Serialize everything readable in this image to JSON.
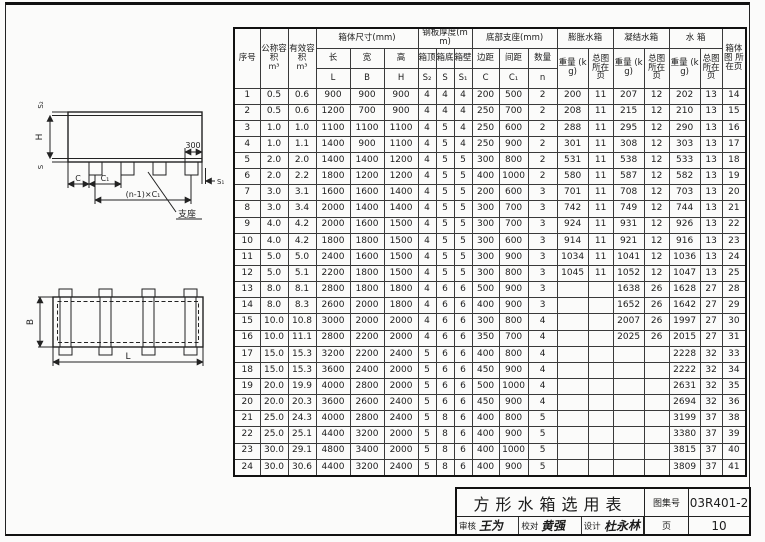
{
  "title_block": {
    "title": "方形水箱选用表",
    "atlas_label": "图集号",
    "atlas_no": "03R401-2",
    "page_label": "页",
    "page_no": "10",
    "reviewer_label": "审核",
    "reviewer": "王为",
    "checker_label": "校对",
    "checker": "黄强",
    "designer_label": "设计",
    "designer": "杜永林"
  },
  "diagrams": {
    "elevation": {
      "s_top": "S₂",
      "h": "H",
      "s_bottom": "S",
      "dim_300": "300",
      "s_side": "S₁",
      "c": "C",
      "c1": "C₁",
      "span": "(n-1)×C₁",
      "support": "支座"
    },
    "plan": {
      "b": "B",
      "l": "L"
    }
  },
  "table": {
    "header": {
      "seq": "序号",
      "nominal": "公称容积",
      "effective": "有效容积",
      "unit": "m³",
      "dims_group": "箱体尺寸(mm)",
      "dim_cn": [
        "长",
        "宽",
        "高"
      ],
      "dim_sym": [
        "L",
        "B",
        "H"
      ],
      "steel_group": "钢板厚度(mm)",
      "steel_cn": [
        "箱顶",
        "箱底",
        "箱壁"
      ],
      "steel_sym": [
        "S₂",
        "S",
        "S₁"
      ],
      "support_group": "底部支座(mm)",
      "support_cn": [
        "边距",
        "间距",
        "数量"
      ],
      "support_sym": [
        "C",
        "C₁",
        "n"
      ],
      "groups": [
        {
          "name": "膨胀水箱"
        },
        {
          "name": "凝结水箱"
        },
        {
          "name": "水 箱"
        }
      ],
      "weight": "重量 (kg)",
      "page_ref": "总图 所在页",
      "body_page": "箱体图 所在页"
    },
    "rows": [
      [
        "1",
        "0.5",
        "0.6",
        "900",
        "900",
        "900",
        "4",
        "4",
        "4",
        "200",
        "500",
        "2",
        "200",
        "11",
        "207",
        "12",
        "202",
        "13",
        "14"
      ],
      [
        "2",
        "0.5",
        "0.6",
        "1200",
        "700",
        "900",
        "4",
        "4",
        "4",
        "250",
        "700",
        "2",
        "208",
        "11",
        "215",
        "12",
        "210",
        "13",
        "15"
      ],
      [
        "3",
        "1.0",
        "1.0",
        "1100",
        "1100",
        "1100",
        "4",
        "5",
        "4",
        "250",
        "600",
        "2",
        "288",
        "11",
        "295",
        "12",
        "290",
        "13",
        "16"
      ],
      [
        "4",
        "1.0",
        "1.1",
        "1400",
        "900",
        "1100",
        "4",
        "5",
        "4",
        "250",
        "900",
        "2",
        "301",
        "11",
        "308",
        "12",
        "303",
        "13",
        "17"
      ],
      [
        "5",
        "2.0",
        "2.0",
        "1400",
        "1400",
        "1200",
        "4",
        "5",
        "5",
        "300",
        "800",
        "2",
        "531",
        "11",
        "538",
        "12",
        "533",
        "13",
        "18"
      ],
      [
        "6",
        "2.0",
        "2.2",
        "1800",
        "1200",
        "1200",
        "4",
        "5",
        "5",
        "400",
        "1000",
        "2",
        "580",
        "11",
        "587",
        "12",
        "582",
        "13",
        "19"
      ],
      [
        "7",
        "3.0",
        "3.1",
        "1600",
        "1600",
        "1400",
        "4",
        "5",
        "5",
        "200",
        "600",
        "3",
        "701",
        "11",
        "708",
        "12",
        "703",
        "13",
        "20"
      ],
      [
        "8",
        "3.0",
        "3.4",
        "2000",
        "1400",
        "1400",
        "4",
        "5",
        "5",
        "300",
        "700",
        "3",
        "742",
        "11",
        "749",
        "12",
        "744",
        "13",
        "21"
      ],
      [
        "9",
        "4.0",
        "4.2",
        "2000",
        "1600",
        "1500",
        "4",
        "5",
        "5",
        "300",
        "700",
        "3",
        "924",
        "11",
        "931",
        "12",
        "926",
        "13",
        "22"
      ],
      [
        "10",
        "4.0",
        "4.2",
        "1800",
        "1800",
        "1500",
        "4",
        "5",
        "5",
        "300",
        "600",
        "3",
        "914",
        "11",
        "921",
        "12",
        "916",
        "13",
        "23"
      ],
      [
        "11",
        "5.0",
        "5.0",
        "2400",
        "1600",
        "1500",
        "4",
        "5",
        "5",
        "300",
        "900",
        "3",
        "1034",
        "11",
        "1041",
        "12",
        "1036",
        "13",
        "24"
      ],
      [
        "12",
        "5.0",
        "5.1",
        "2200",
        "1800",
        "1500",
        "4",
        "5",
        "5",
        "300",
        "800",
        "3",
        "1045",
        "11",
        "1052",
        "12",
        "1047",
        "13",
        "25"
      ],
      [
        "13",
        "8.0",
        "8.1",
        "2800",
        "1800",
        "1800",
        "4",
        "6",
        "6",
        "500",
        "900",
        "3",
        "",
        "",
        "1638",
        "26",
        "1628",
        "27",
        "28"
      ],
      [
        "14",
        "8.0",
        "8.3",
        "2600",
        "2000",
        "1800",
        "4",
        "6",
        "6",
        "400",
        "900",
        "3",
        "",
        "",
        "1652",
        "26",
        "1642",
        "27",
        "29"
      ],
      [
        "15",
        "10.0",
        "10.8",
        "3000",
        "2000",
        "2000",
        "4",
        "6",
        "6",
        "300",
        "800",
        "4",
        "",
        "",
        "2007",
        "26",
        "1997",
        "27",
        "30"
      ],
      [
        "16",
        "10.0",
        "11.1",
        "2800",
        "2200",
        "2000",
        "4",
        "6",
        "6",
        "350",
        "700",
        "4",
        "",
        "",
        "2025",
        "26",
        "2015",
        "27",
        "31"
      ],
      [
        "17",
        "15.0",
        "15.3",
        "3200",
        "2200",
        "2400",
        "5",
        "6",
        "6",
        "400",
        "800",
        "4",
        "",
        "",
        "",
        "",
        "2228",
        "32",
        "33"
      ],
      [
        "18",
        "15.0",
        "15.3",
        "3600",
        "2400",
        "2000",
        "5",
        "6",
        "6",
        "450",
        "900",
        "4",
        "",
        "",
        "",
        "",
        "2222",
        "32",
        "34"
      ],
      [
        "19",
        "20.0",
        "19.9",
        "4000",
        "2800",
        "2000",
        "5",
        "6",
        "6",
        "500",
        "1000",
        "4",
        "",
        "",
        "",
        "",
        "2631",
        "32",
        "35"
      ],
      [
        "20",
        "20.0",
        "20.3",
        "3600",
        "2600",
        "2400",
        "5",
        "6",
        "6",
        "450",
        "900",
        "4",
        "",
        "",
        "",
        "",
        "2694",
        "32",
        "36"
      ],
      [
        "21",
        "25.0",
        "24.3",
        "4000",
        "2800",
        "2400",
        "5",
        "8",
        "6",
        "400",
        "800",
        "5",
        "",
        "",
        "",
        "",
        "3199",
        "37",
        "38"
      ],
      [
        "22",
        "25.0",
        "25.1",
        "4400",
        "3200",
        "2000",
        "5",
        "8",
        "6",
        "400",
        "900",
        "5",
        "",
        "",
        "",
        "",
        "3380",
        "37",
        "39"
      ],
      [
        "23",
        "30.0",
        "29.1",
        "4800",
        "3400",
        "2000",
        "5",
        "8",
        "6",
        "400",
        "1000",
        "5",
        "",
        "",
        "",
        "",
        "3815",
        "37",
        "40"
      ],
      [
        "24",
        "30.0",
        "30.6",
        "4400",
        "3200",
        "2400",
        "5",
        "8",
        "6",
        "400",
        "900",
        "5",
        "",
        "",
        "",
        "",
        "3809",
        "37",
        "41"
      ]
    ]
  }
}
